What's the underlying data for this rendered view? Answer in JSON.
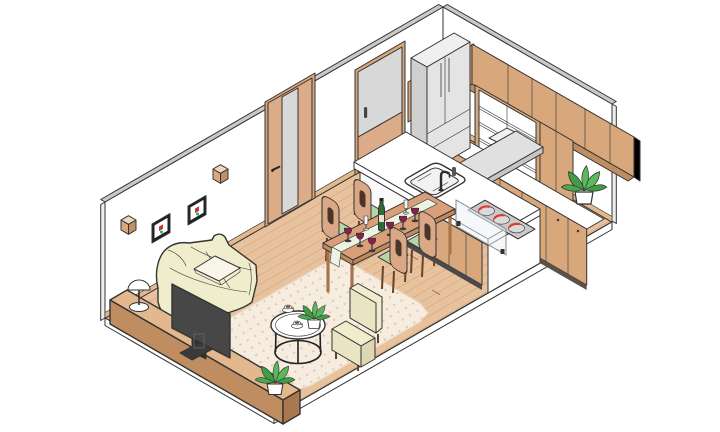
{
  "title": "Isometric cutaway illustration of an apartment interior with living room and open kitchen",
  "style": "flat isometric vector illustration, dark outlines, white background",
  "palette": {
    "background": "#ffffff",
    "outline": "#333333",
    "wall_white": "#ffffff",
    "wall_edge_gray": "#c9c9c9",
    "wall_side_gray": "#ededed",
    "floor_wood": "#e7c29d",
    "floor_line": "#c99c72",
    "platform_white": "#ffffff",
    "rug_base": "#f6ecdf",
    "rug_dot": "#e0c9ab",
    "wood_light": "#e3b88e",
    "wood": "#d9a77c",
    "wood_dark": "#c08d61",
    "wood_deep": "#a9784f",
    "door_glass": "#d8d8d8",
    "appliance_gray": "#e4e4e4",
    "appliance_side": "#cfcfcf",
    "hood_gray": "#e0e0e0",
    "counter_white": "#ffffff",
    "cream": "#f0edcd",
    "pillow_white": "#f8f6ea",
    "tv_dark": "#474747",
    "tv_deep": "#2e2e2e",
    "seat_green": "#b7d6a4",
    "runner_green": "#edf3e2",
    "leaf_green": "#5cb85c",
    "leaf_dark": "#3e9d45",
    "wine_red": "#8e1f48",
    "bottle_green": "#2e6b35",
    "burner_red": "#e0392f",
    "coffee_brown": "#7a4a28",
    "table_wood": "#d89f78",
    "leg_wood": "#a9744c"
  },
  "objects": [
    {
      "id": "back-wall",
      "label": "back wall"
    },
    {
      "id": "right-wall",
      "label": "right wall"
    },
    {
      "id": "wood-floor",
      "label": "wood plank floor"
    },
    {
      "id": "area-rug",
      "label": "beige dotted area rug"
    },
    {
      "id": "wall-cube-shelf",
      "label": "wooden cube wall shelf",
      "count": 2
    },
    {
      "id": "picture-frame",
      "label": "framed picture",
      "count": 2
    },
    {
      "id": "interior-door",
      "label": "hinged interior door with glass strip"
    },
    {
      "id": "sliding-door",
      "label": "sliding glass door"
    },
    {
      "id": "refrigerator",
      "label": "refrigerator"
    },
    {
      "id": "upper-cabinets",
      "label": "upper wall cabinets"
    },
    {
      "id": "open-shelving",
      "label": "open shelf unit"
    },
    {
      "id": "range-hood",
      "label": "range hood"
    },
    {
      "id": "base-cabinets",
      "label": "base cabinets with counter"
    },
    {
      "id": "counter-plant",
      "label": "potted plant on counter"
    },
    {
      "id": "kitchen-island",
      "label": "kitchen island"
    },
    {
      "id": "sink",
      "label": "kitchen sink"
    },
    {
      "id": "faucet",
      "label": "faucet"
    },
    {
      "id": "cooktop",
      "label": "cooktop",
      "burners": 3
    },
    {
      "id": "glass-splash-guard",
      "label": "glass splash guard"
    },
    {
      "id": "dining-table",
      "label": "dining table"
    },
    {
      "id": "table-runner",
      "label": "table runner"
    },
    {
      "id": "wine-bottle",
      "label": "wine bottle"
    },
    {
      "id": "wine-glass",
      "label": "red wine glass",
      "count": 6
    },
    {
      "id": "champagne-flute",
      "label": "champagne flute",
      "count": 2
    },
    {
      "id": "dining-chair",
      "label": "dining chair with green seat",
      "count": 4
    },
    {
      "id": "sofa",
      "label": "cream sofa"
    },
    {
      "id": "throw-pillow",
      "label": "throw pillow"
    },
    {
      "id": "armchair",
      "label": "cream armchair"
    },
    {
      "id": "coffee-table",
      "label": "round coffee table"
    },
    {
      "id": "coffee-cup",
      "label": "coffee cup with saucer",
      "count": 2
    },
    {
      "id": "coffee-table-plant",
      "label": "small plant on coffee table"
    },
    {
      "id": "tv-console",
      "label": "low wooden TV console"
    },
    {
      "id": "table-lamp",
      "label": "dome table lamp"
    },
    {
      "id": "television",
      "label": "flat screen television"
    },
    {
      "id": "console-plant",
      "label": "potted plant on console"
    }
  ]
}
